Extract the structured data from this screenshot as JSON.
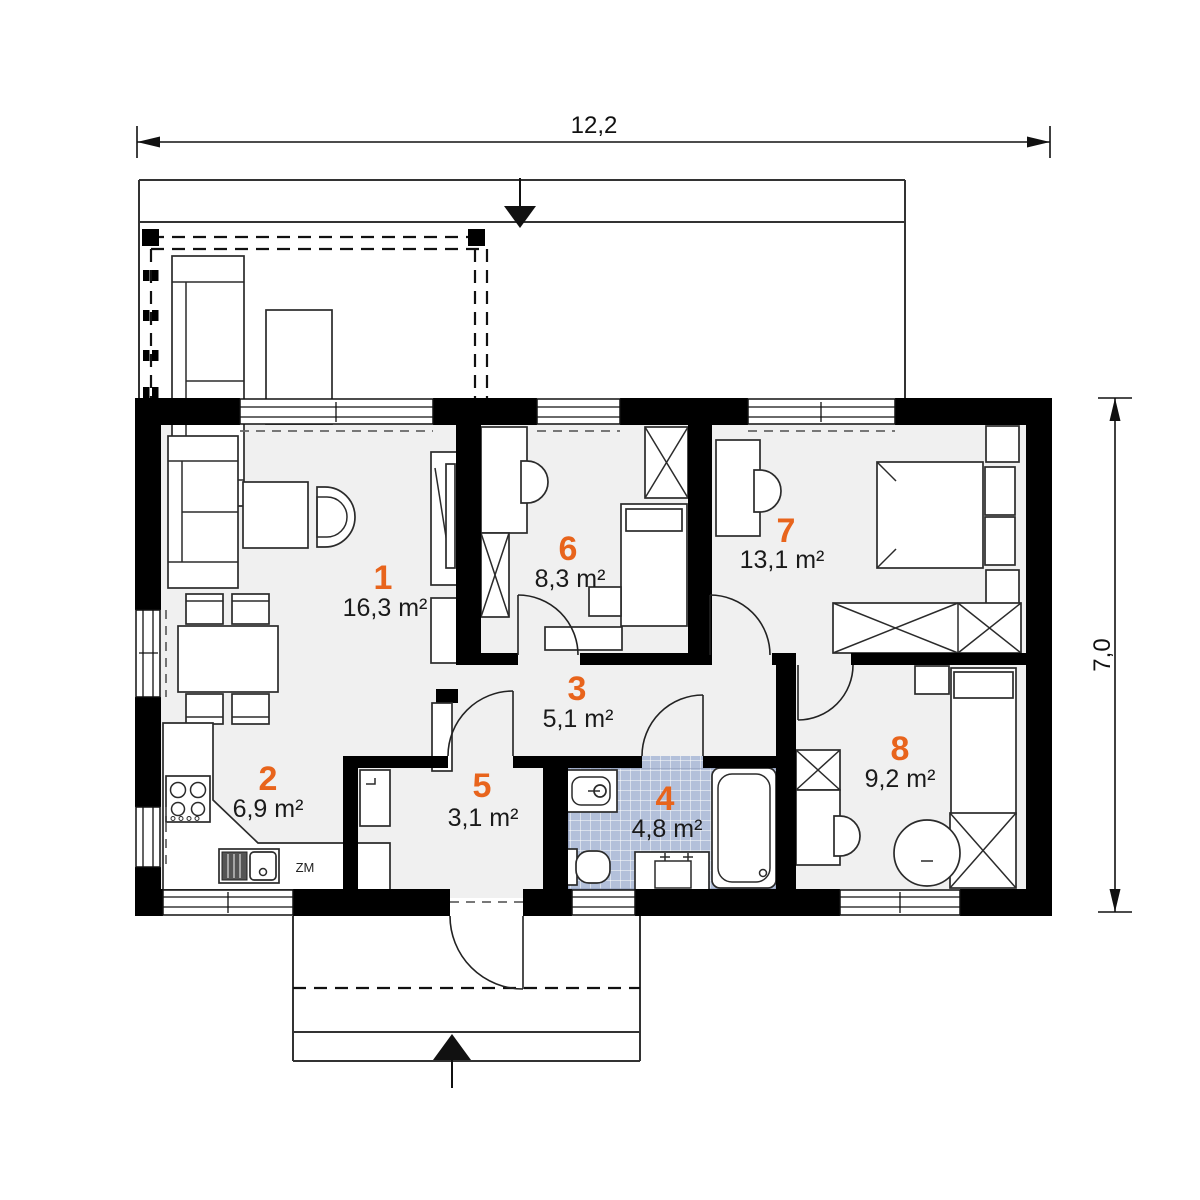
{
  "plan": {
    "type": "floor-plan",
    "dimension_top": "12,2",
    "dimension_right": "7,0",
    "rooms": [
      {
        "number": "1",
        "area": "16,3 m²"
      },
      {
        "number": "2",
        "area": "6,9 m²"
      },
      {
        "number": "3",
        "area": "5,1 m²"
      },
      {
        "number": "4",
        "area": "4,8 m²"
      },
      {
        "number": "5",
        "area": "3,1 m²"
      },
      {
        "number": "6",
        "area": "8,3 m²"
      },
      {
        "number": "7",
        "area": "13,1 m²"
      },
      {
        "number": "8",
        "area": "9,2 m²"
      }
    ],
    "annotations": {
      "dishwasher": "ZM"
    },
    "colors": {
      "room_number_accent": "#e8641c",
      "walls": "#000000",
      "floor": "#f0f0f0",
      "bath_tile": "#b3c0da"
    }
  }
}
